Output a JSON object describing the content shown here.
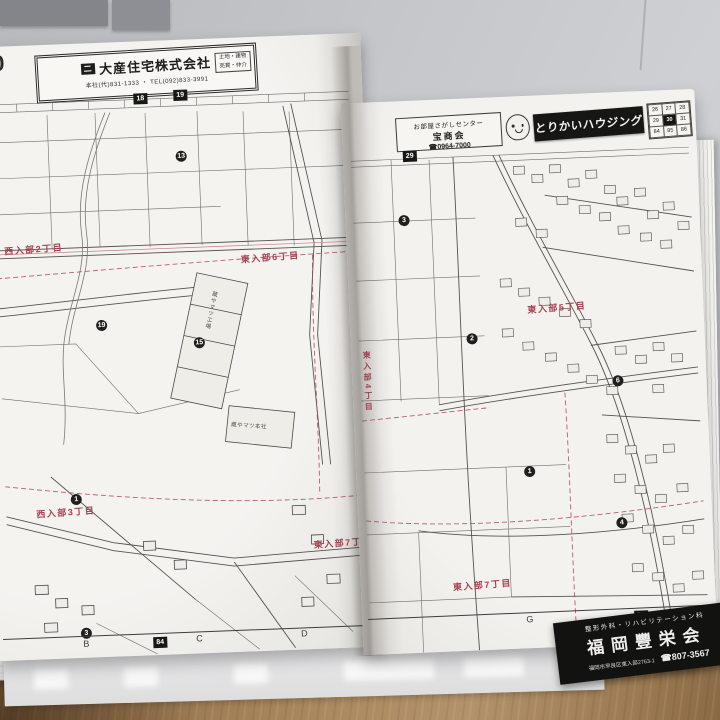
{
  "left_page": {
    "page_number": "30",
    "ad": {
      "company": "大産住宅株式会社",
      "logo_glyph": "二",
      "phone": "本社(代)831-1333 ・ TEL(092)833-3991",
      "note_line1": "土地・建物",
      "note_line2": "売買・仲介"
    },
    "top_links": [
      "18",
      "19"
    ],
    "area_labels": [
      "西入部2丁目",
      "東入部6丁目",
      "西入部3丁目",
      "東入部7丁目"
    ],
    "building_labels": [
      "蔵やマツ工場",
      "蔵やマツ本社"
    ],
    "circled_numbers": [
      "13",
      "19",
      "15",
      "1",
      "3"
    ],
    "grid_letters": [
      "B",
      "C",
      "D"
    ],
    "bottom_link": "84"
  },
  "right_page": {
    "ad": {
      "box_line1": "お部屋さがしセンター",
      "box_line2": "宝商会",
      "box_phone": "☎0964-7000",
      "banner": "とりかいハウジング",
      "locator": [
        [
          "26",
          "27",
          "28"
        ],
        [
          "29",
          "30",
          "31"
        ],
        [
          "84",
          "85",
          "86"
        ]
      ]
    },
    "top_link": "29",
    "area_labels": [
      "東入部5丁目",
      "東入部7丁目",
      "東入部4丁目"
    ],
    "circled_numbers": [
      "3",
      "2",
      "6",
      "1",
      "4"
    ],
    "grid_letters": [
      "G",
      "H"
    ],
    "bottom_link": "84",
    "bottom_ad": {
      "line1": "整形外科・リハビリテーション科",
      "name": "福岡豐栄会",
      "address": "福岡市早良区東入部2763-1",
      "phone": "☎807-3567"
    }
  }
}
